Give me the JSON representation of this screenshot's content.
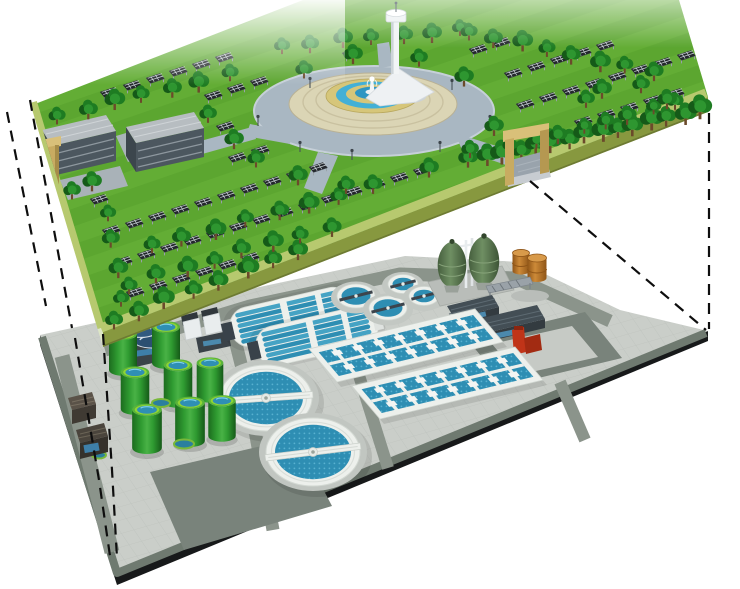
{
  "canvas": {
    "width": 740,
    "height": 589,
    "background": "#ffffff"
  },
  "scene": {
    "type": "3d-architectural-cutaway-illustration",
    "subject": "Exploded-view rendering: rooftop solar park above an underground wastewater treatment plant, linked by dashed projection lines",
    "layers": [
      "rooftop-solar-park",
      "treatment-plant-floor"
    ]
  },
  "colors": {
    "bg": "#ffffff",
    "grass": "#63ad35",
    "grassDark": "#55a02c",
    "rim": "#b7c96f",
    "slabSide": "#87983f",
    "slabSideLeft": "#dde6c6",
    "panel": "#23272c",
    "panelLine": "#ccd4d8",
    "tree": "#1e7c22",
    "treeDark": "#155a18",
    "treeLight": "#2e9630",
    "plazaRoad": "#a9b7c2",
    "plazaPave": "#dbd5b5",
    "fountainRim": "#d6c67a",
    "fountainWater": "#43b0d6",
    "buildingRoof": "#b7bdc1",
    "buildingSide": "#4c575f",
    "gateTan": "#c8ab61",
    "gateTanDark": "#b59851",
    "gateTanLight": "#d9c079",
    "plate": "#c8ccc7",
    "plateBorder": "#6f7a70",
    "plateSide": "#17191a",
    "road": "#8b948b",
    "roadDark": "#79837b",
    "tankGreen": "#2f9b31",
    "tankGreenDark": "#1c6b1e",
    "tankRim": "#8fd435",
    "basinBlue": "#2e8eb3",
    "basinBlueLight": "#45a3c4",
    "clarWhite": "#edf0ec",
    "eggOlive": "#66855c",
    "eggOliveDark": "#465f3e",
    "barrelOrange": "#bd7427",
    "redUnit": "#c03418",
    "thickenerNavy": "#2b4f71",
    "dashedLine": "#0e0e0e"
  },
  "upper_layer": {
    "name": "rooftop-solar-park",
    "components": {
      "solar_panels": {
        "arrangement": "diagonal grid rows",
        "approx_count": 180
      },
      "trees": {
        "approx_count": 90
      },
      "fountain_plaza": {
        "shape": "circular",
        "rings": [
          "gray ring road",
          "tan paved disc",
          "tan fountain rim",
          "blue water ring",
          "tan ring",
          "blue pool",
          "white sculpture"
        ]
      },
      "observation_tower": {
        "count": 1,
        "color": "white"
      },
      "service_buildings": {
        "count": 2,
        "roof": "light gray",
        "walls": "dark gray louvers"
      },
      "entrance_gates": {
        "count": 2,
        "color": "tan",
        "right_gate_has_ramp": true
      }
    }
  },
  "lower_layer": {
    "name": "treatment-plant-floor",
    "components": {
      "green_storage_tanks": {
        "count": 8,
        "top": "blue water with green rim"
      },
      "ground_ponds": {
        "count": 3
      },
      "secondary_clarifiers": {
        "count": 2,
        "detail": "white ring, blue water, rotating bridge"
      },
      "oxidation_ditches": {
        "count": 2,
        "lanes": 6
      },
      "aeration_basin_blocks": {
        "count": 2,
        "dividers_each": 7
      },
      "small_round_tanks": {
        "count": 4
      },
      "egg_digesters": {
        "count": 2,
        "color": "olive green"
      },
      "fuel_drums": {
        "count": 2,
        "color": "orange-brown"
      },
      "thickener_tanks": {
        "count": 2,
        "color": "navy"
      },
      "hoppers": {
        "count": 2,
        "color": "white"
      },
      "sheds": {
        "count": 3,
        "color": "dark gray"
      },
      "red_pump_unit": {
        "count": 1
      },
      "roadside_kiosks": {
        "count": 2
      },
      "road_loop": {
        "count": 1
      }
    }
  },
  "projection": {
    "dashed_lines_left": 4,
    "dashed_lines_right": 2,
    "style": "black dashed"
  },
  "render": {
    "panel_lattice": {
      "origin": [
        30,
        44
      ],
      "du": [
        23,
        -7
      ],
      "dv": [
        12,
        31
      ],
      "rows": 14,
      "cols": 28
    },
    "tree_rows": [
      {
        "p": [
          470,
          162,
          700,
          112
        ],
        "n": 15,
        "s": 1.15
      },
      {
        "p": [
          512,
          148,
          676,
          104
        ],
        "n": 8,
        "s": 0.9
      },
      {
        "p": [
          112,
          322,
          300,
          252
        ],
        "n": 8,
        "s": 1.05
      },
      {
        "p": [
          128,
          286,
          330,
          228
        ],
        "n": 8,
        "s": 1.0
      },
      {
        "p": [
          152,
          248,
          372,
          188
        ],
        "n": 8,
        "s": 1.0
      },
      {
        "p": [
          58,
          118,
          228,
          76
        ],
        "n": 7,
        "s": 1.0
      },
      {
        "p": [
          282,
          48,
          462,
          31
        ],
        "n": 7,
        "s": 0.95
      },
      {
        "p": [
          468,
          34,
          652,
          74
        ],
        "n": 8,
        "s": 1.0
      },
      {
        "p": [
          108,
          214,
          122,
          300
        ],
        "n": 4,
        "s": 0.95
      }
    ],
    "tree_singles": [
      [
        232,
        140
      ],
      [
        256,
        162
      ],
      [
        300,
        178
      ],
      [
        345,
        186
      ],
      [
        430,
        172
      ],
      [
        468,
        152
      ],
      [
        494,
        128
      ],
      [
        306,
        70
      ],
      [
        352,
        58
      ],
      [
        420,
        60
      ],
      [
        462,
        78
      ],
      [
        208,
        118
      ],
      [
        604,
        92
      ],
      [
        640,
        86
      ],
      [
        668,
        100
      ],
      [
        70,
        194
      ],
      [
        92,
        184
      ],
      [
        588,
        100
      ]
    ],
    "lamps": [
      [
        258,
        126
      ],
      [
        300,
        152
      ],
      [
        352,
        160
      ],
      [
        440,
        152
      ],
      [
        490,
        126
      ],
      [
        452,
        90
      ],
      [
        310,
        88
      ]
    ],
    "green_tanks": [
      [
        123,
        372,
        1
      ],
      [
        166,
        365,
        1
      ],
      [
        135,
        411,
        1.02
      ],
      [
        178,
        404,
        1.02
      ],
      [
        210,
        399,
        0.95
      ],
      [
        147,
        450,
        1.06
      ],
      [
        190,
        443,
        1.06
      ],
      [
        222,
        438,
        0.98
      ]
    ],
    "ground_ponds": [
      [
        161,
        403,
        9,
        4
      ],
      [
        184,
        444,
        10,
        4.5
      ],
      [
        99,
        455,
        7,
        3.5
      ]
    ],
    "round_tanks": [
      [
        356,
        296,
        19,
        12
      ],
      [
        388,
        308,
        19,
        12
      ],
      [
        403,
        284,
        15,
        9.5
      ],
      [
        424,
        296,
        15,
        9.5
      ]
    ],
    "clarifiers": [
      {
        "c": [
          266,
          398
        ],
        "rx": 46,
        "ry": 33,
        "a": -4
      },
      {
        "c": [
          313,
          452
        ],
        "rx": 47,
        "ry": 34,
        "a": -7
      }
    ],
    "ditches": [
      {
        "c": [
          291,
          317
        ],
        "a": -13
      },
      {
        "c": [
          317,
          336
        ],
        "a": -13
      }
    ],
    "basins": [
      {
        "tl": [
          309,
          349
        ],
        "u": [
          166,
          -40
        ],
        "v": [
          28,
          33
        ],
        "dividers": 7
      },
      {
        "tl": [
          352,
          386
        ],
        "u": [
          163,
          -39
        ],
        "v": [
          28,
          33
        ],
        "dividers": 7
      }
    ],
    "eggs": [
      [
        452,
        266
      ],
      [
        484,
        262
      ]
    ],
    "barrels": [
      [
        521,
        271
      ],
      [
        537,
        278
      ]
    ],
    "dashed_lines": [
      [
        [
          30,
          100
        ],
        [
          72,
          328
        ]
      ],
      [
        [
          7,
          112
        ],
        [
          46,
          306
        ]
      ],
      [
        [
          75,
          338
        ],
        [
          99,
          480
        ],
        [
          110,
          556
        ]
      ],
      [
        [
          103,
          334
        ],
        [
          112,
          470
        ],
        [
          117,
          558
        ]
      ],
      [
        [
          709,
          113
        ],
        [
          709,
          329
        ]
      ],
      [
        [
          530,
          181
        ],
        [
          706,
          330
        ]
      ]
    ]
  }
}
